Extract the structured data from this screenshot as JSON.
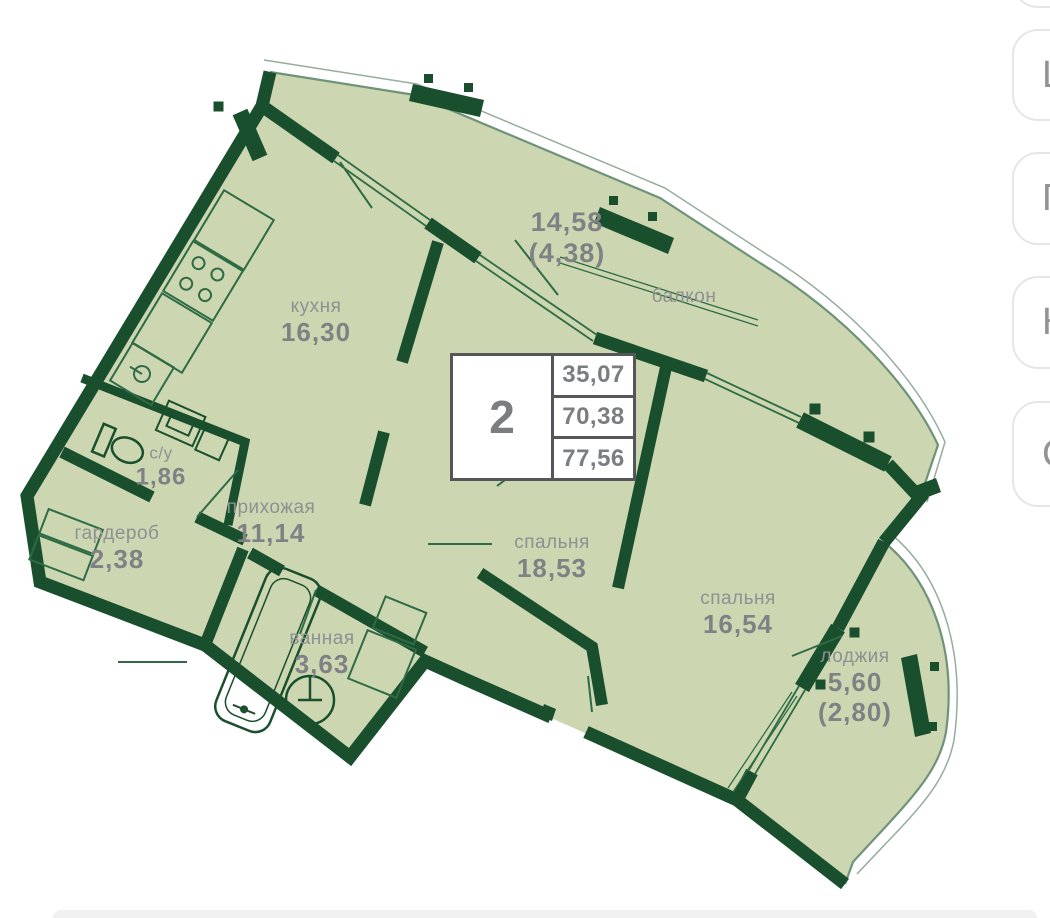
{
  "plan": {
    "info_box": {
      "rooms_count": "2",
      "areas": [
        "35,07",
        "70,38",
        "77,56"
      ]
    },
    "labels": {
      "kitchen": {
        "name": "кухня",
        "area": "16,30"
      },
      "balcony": {
        "name": "балкон",
        "area": "14,58",
        "area_half": "(4,38)"
      },
      "wc": {
        "name": "с/у",
        "area": "1,86"
      },
      "wardrobe": {
        "name": "гардероб",
        "area": "2,38"
      },
      "hallway": {
        "name": "прихожая",
        "area": "11,14"
      },
      "bedroom_main": {
        "name": "спальня",
        "area": "18,53"
      },
      "bedroom_second": {
        "name": "спальня",
        "area": "16,54"
      },
      "bathroom": {
        "name": "ванная",
        "area": "3,63"
      },
      "loggia": {
        "name": "лоджия",
        "area": "5,60",
        "area_half": "(2,80)"
      }
    }
  },
  "side_buttons": [
    {
      "label": "Ш"
    },
    {
      "label": "П"
    },
    {
      "label": "К"
    },
    {
      "label": "С"
    }
  ],
  "colors": {
    "wall": "#1a4f2e",
    "room_fill": "#ccd7b2",
    "thin_line": "#2e6b45",
    "rail_line": "#6f9378",
    "label_text": "#8e9092",
    "area_text": "#7f8184",
    "info_border": "#54565a",
    "button_border": "#e6e6e6",
    "button_text": "#939393"
  }
}
